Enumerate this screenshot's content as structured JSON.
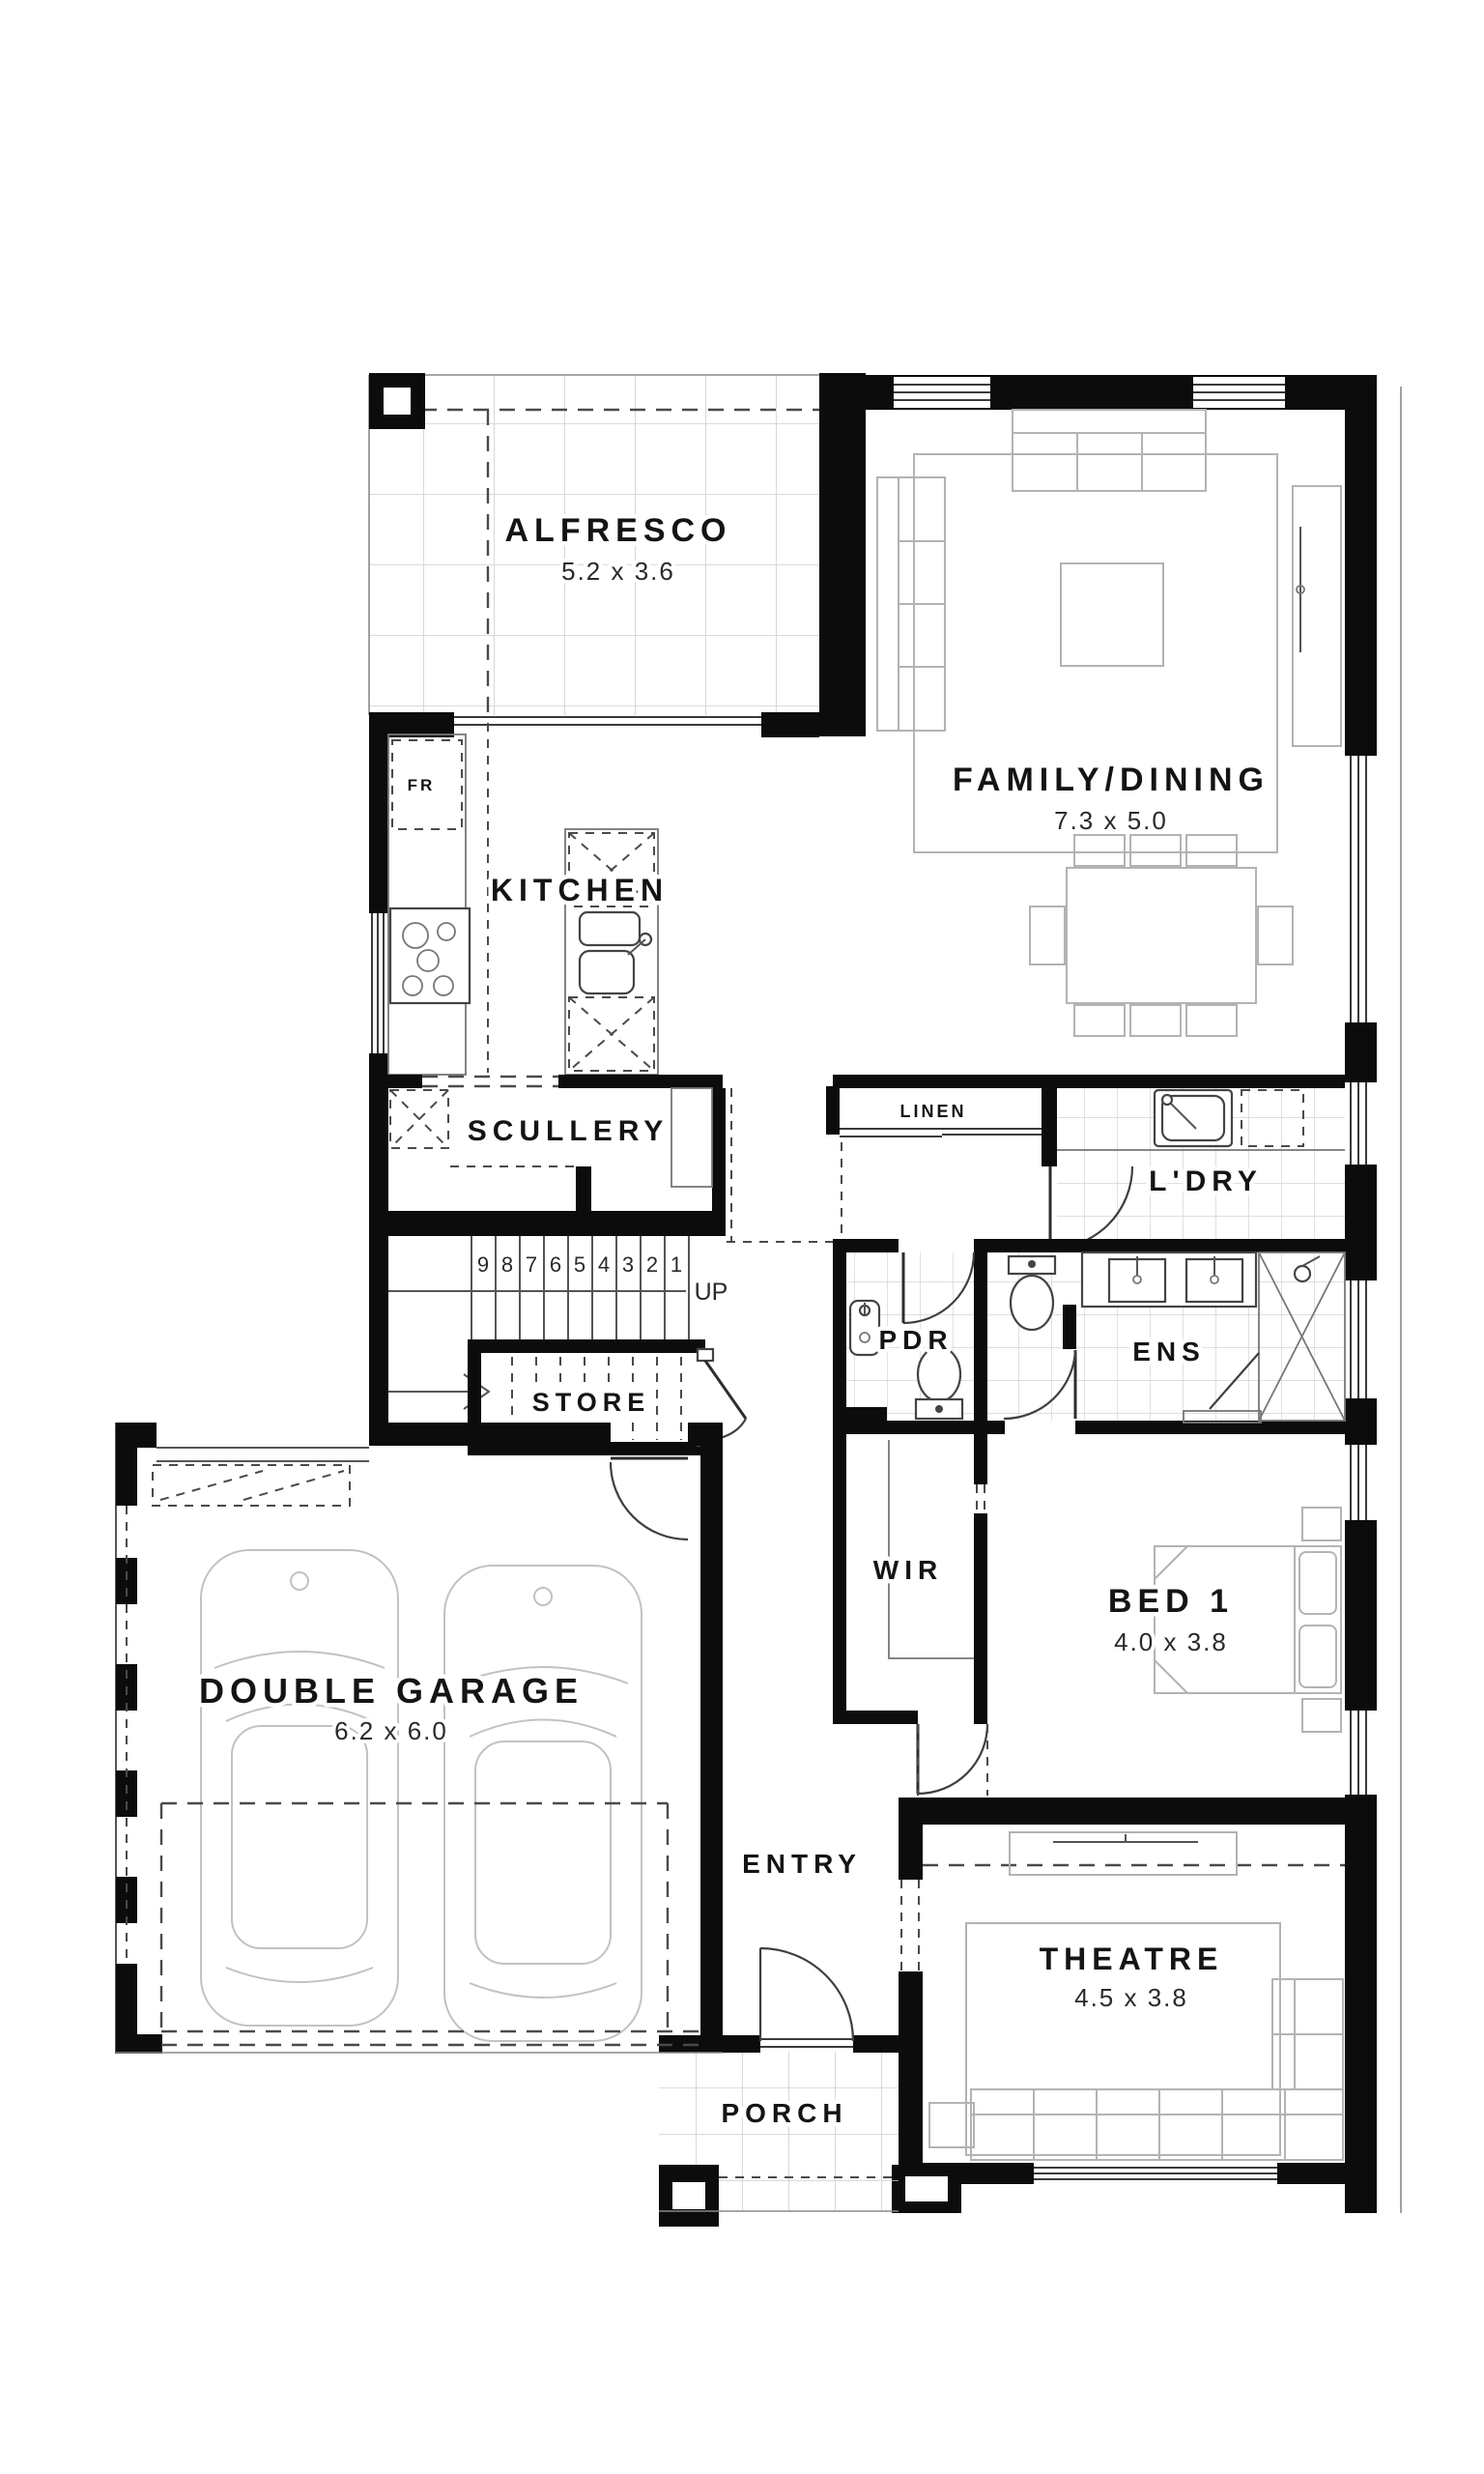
{
  "plan": {
    "rooms": {
      "alfresco": {
        "name": "ALFRESCO",
        "dims": "5.2 x 3.6"
      },
      "family_dining": {
        "name": "FAMILY/DINING",
        "dims": "7.3 x 5.0"
      },
      "kitchen": {
        "name": "KITCHEN"
      },
      "scullery": {
        "name": "SCULLERY"
      },
      "linen": {
        "name": "LINEN"
      },
      "laundry": {
        "name": "L'DRY"
      },
      "powder": {
        "name": "PDR"
      },
      "ensuite": {
        "name": "ENS"
      },
      "store": {
        "name": "STORE"
      },
      "wir": {
        "name": "WIR"
      },
      "bed1": {
        "name": "BED 1",
        "dims": "4.0 x 3.8"
      },
      "garage": {
        "name": "DOUBLE GARAGE",
        "dims": "6.2 x 6.0"
      },
      "entry": {
        "name": "ENTRY"
      },
      "theatre": {
        "name": "THEATRE",
        "dims": "4.5 x 3.8"
      },
      "porch": {
        "name": "PORCH"
      }
    },
    "annotations": {
      "fridge": "FR",
      "stair_direction": "UP",
      "stair_numbers": [
        "9",
        "8",
        "7",
        "6",
        "5",
        "4",
        "3",
        "2",
        "1"
      ]
    },
    "colors": {
      "wall": "#0c0c0c",
      "furniture": "#b3b3b3",
      "tile": "#cfcfcf",
      "dash": "#4a4a4a",
      "background": "#ffffff"
    }
  }
}
